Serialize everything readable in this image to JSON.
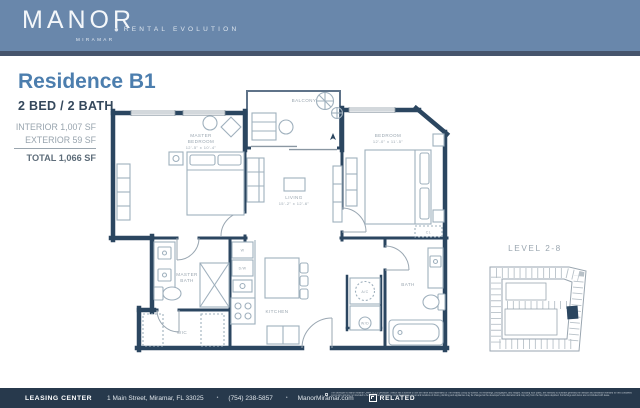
{
  "colors": {
    "header_bg": "#6987ab",
    "stripe": "#46546c",
    "accent_blue": "#4c7eae",
    "navy_text": "#35485c",
    "wall_navy": "#2b4660",
    "muted_gray": "#98a4ae",
    "footer_bg": "#27394c"
  },
  "header": {
    "brand": "MANOR",
    "brand_sub": "MIRAMAR",
    "tagline_dot": "●",
    "tagline": "RENTAL EVOLUTION"
  },
  "info": {
    "residence": "Residence B1",
    "config": "2 BED / 2 BATH",
    "interior": "INTERIOR 1,007 SF",
    "exterior": "EXTERIOR 59 SF",
    "total": "TOTAL 1,066 SF"
  },
  "floorplan": {
    "master_bedroom": {
      "line1": "MASTER",
      "line2": "BEDROOM",
      "dims": "12'-5\" x 10'-4\""
    },
    "bedroom": {
      "line1": "BEDROOM",
      "dims": "12'-0\" x 11'-5\""
    },
    "living": {
      "line1": "LIVING",
      "dims": "15'-2\" x 12'-6\""
    },
    "balcony": "BALCONY",
    "kitchen": "KITCHEN",
    "master_bath": {
      "line1": "MASTER",
      "line2": "BATH"
    },
    "bath": "BATH",
    "wic": "WIC",
    "ac": "A/C",
    "wd": "W/D",
    "w": "W",
    "dw": "D/W",
    "cl": "CL"
  },
  "keyplan": {
    "label": "LEVEL 2-8"
  },
  "footer": {
    "leasing": "LEASING CENTER",
    "address": "1 Main Street, Miramar, FL 33025",
    "sep": "•",
    "phone": "(754) 238-5857",
    "website": "ManorMiramar.com",
    "related": "RELATED",
    "disclaimer": "The developer is Manor Miramar Owner, LLC (\"Developer\") which has a license to use the name and trademarks of The Related Group by license. All renderings, photographs, and images, including floor plans, are intended to illustrate generally the lifestyle and ambiance intended for this completed community and are not intended to be relied upon. Unit sizes, room dimensions, layout and locations of doors, plumbing and appliances may be changed at the developer's sole discretion and may vary from the floor plans depicted. Furnishings and decor are not included with lease."
  }
}
